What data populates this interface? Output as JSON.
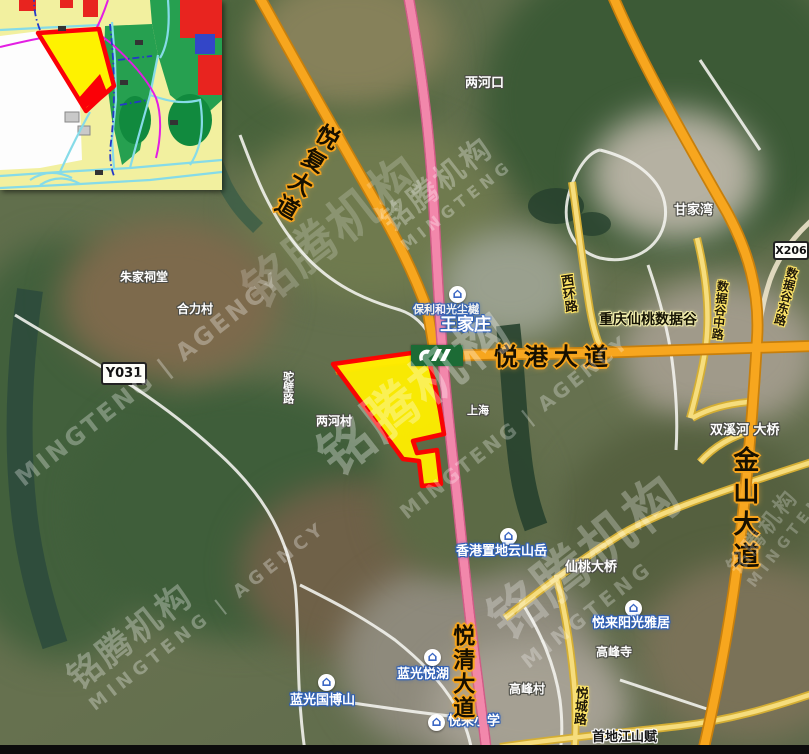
{
  "watermark": {
    "cn": "铭腾机构",
    "en": "MINGTENG | AGENCY",
    "en_short": "MINGTENG"
  },
  "shields": {
    "x206": "X206",
    "y031": "Y031"
  },
  "roads": {
    "yuefu": "悦复大道",
    "yuegang": "悦港大道",
    "jinshan": "金山大道",
    "yueqing": "悦清大道",
    "shujugu_dong": "数据谷东路",
    "shujugu_zhong": "数据谷中路",
    "xihuan": "西环路",
    "yuecheng": "悦城路",
    "tuobi": "驼壁路"
  },
  "places": {
    "lianghekou": "两河口",
    "ganjiawan": "甘家湾",
    "zhujiacitang": "朱家祠堂",
    "helicun": "合力村",
    "lianghecun": "两河村",
    "shanghai": "上海",
    "gaofengsi": "高峰寺",
    "gaofengcun": "高峰村",
    "xiantao_bridge": "仙桃大桥",
    "shuangxihe_bridge": "双溪河 大桥",
    "shoudi": "首地江山赋",
    "data_valley": "重庆仙桃数据谷",
    "wangjiazhuang": "王家庄"
  },
  "pois": {
    "baoli": "保利和光尘樾",
    "languang_guoboshan": "蓝光国博山",
    "languang_yuehu": "蓝光悦湖",
    "yuelai_yangguang": "悦来阳光雅居",
    "xianggang_zhidi": "香港置地云山岳",
    "yuelai_school": "悦来小学"
  },
  "colors": {
    "road_orange": "#f6a21d",
    "road_pink": "#f287ab",
    "road_yellow": "#ecc94e",
    "parcel_fill": "#ffee00",
    "parcel_border": "#ff0000",
    "poi_blue": "#3b67c4",
    "rail_logo_green": "#1c6b35"
  }
}
